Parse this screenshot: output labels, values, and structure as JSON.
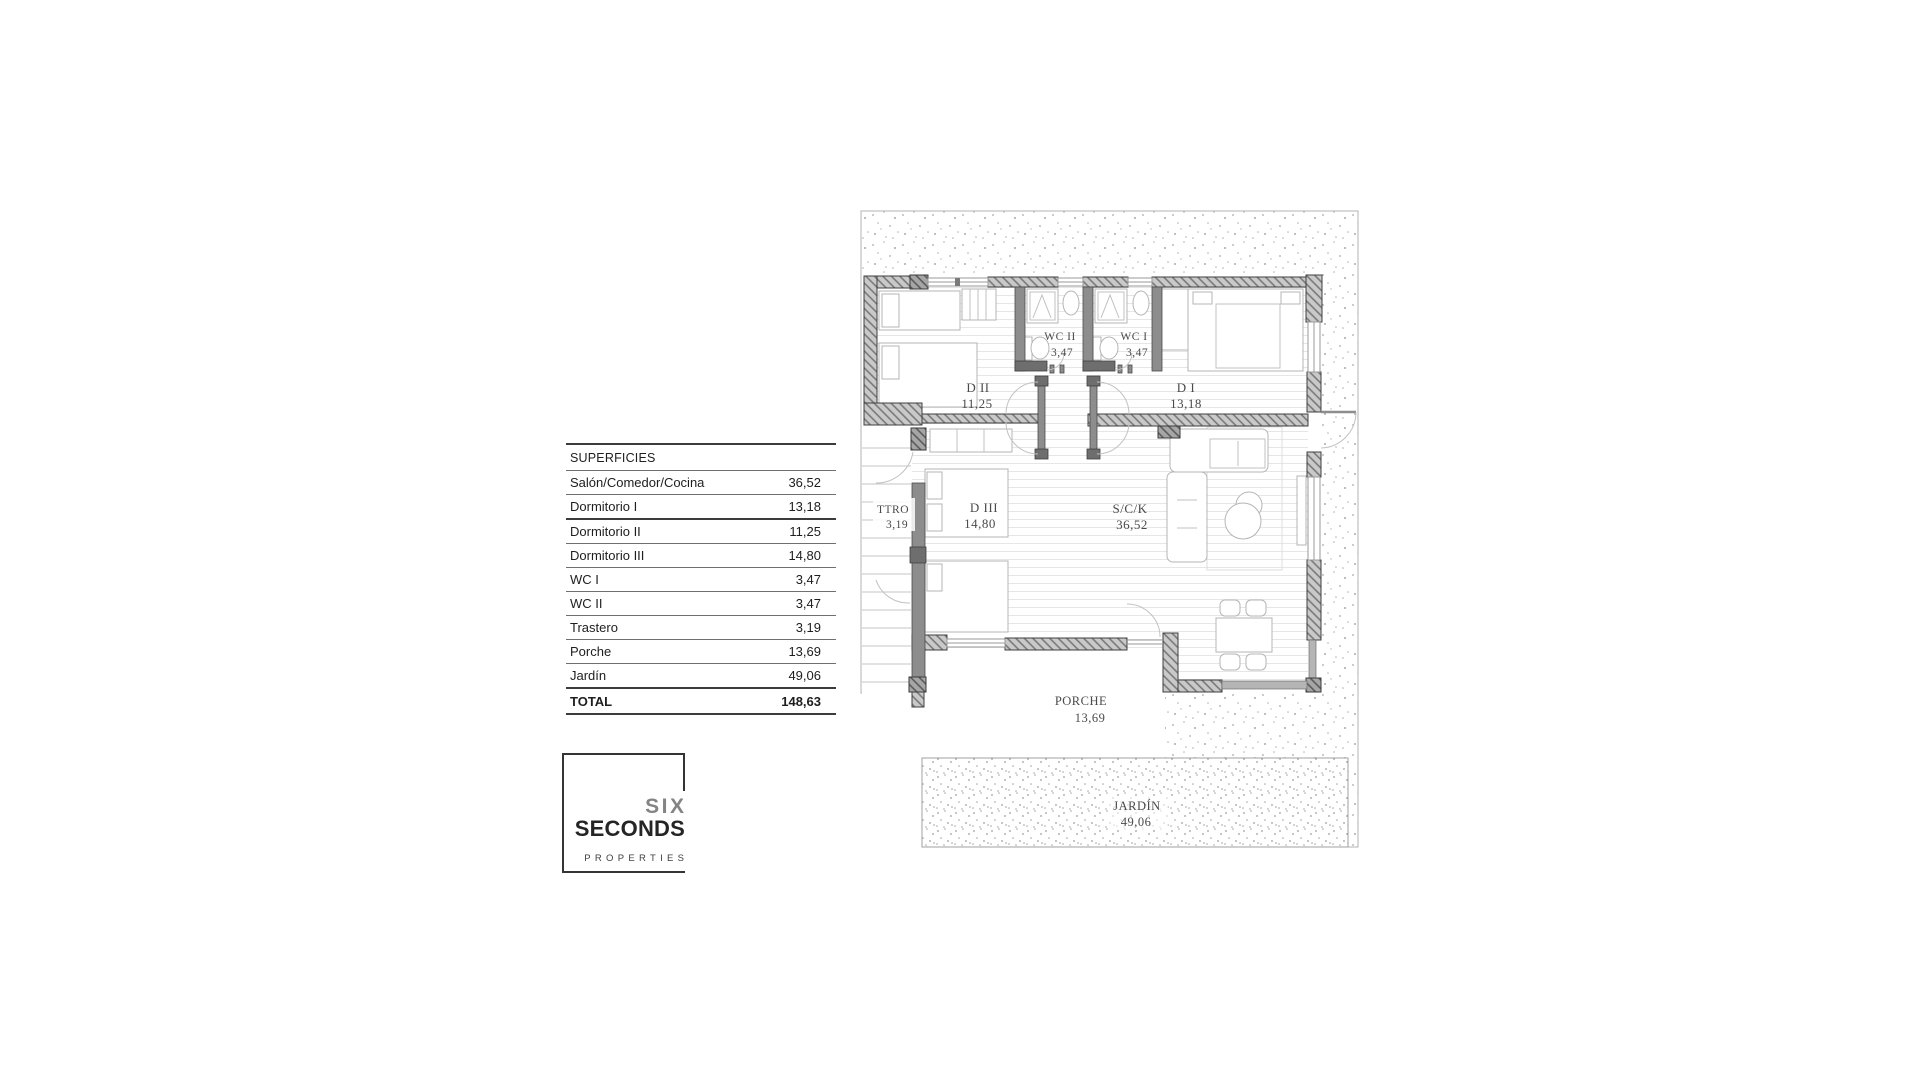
{
  "surfaces_table": {
    "header": "SUPERFICIES",
    "rows": [
      {
        "label": "Salón/Comedor/Cocina",
        "value": "36,52"
      },
      {
        "label": "Dormitorio I",
        "value": "13,18"
      },
      {
        "label": "Dormitorio II",
        "value": "11,25"
      },
      {
        "label": "Dormitorio III",
        "value": "14,80"
      },
      {
        "label": "WC I",
        "value": "3,47"
      },
      {
        "label": "WC II",
        "value": "3,47"
      },
      {
        "label": "Trastero",
        "value": "3,19"
      },
      {
        "label": "Porche",
        "value": "13,69"
      },
      {
        "label": "Jardín",
        "value": "49,06"
      }
    ],
    "total": {
      "label": "TOTAL",
      "value": "148,63"
    }
  },
  "logo": {
    "line1": "SIX",
    "line2": "SECONDS",
    "line3": "PROPERTIES"
  },
  "floorplan": {
    "rooms": [
      {
        "name": "D II",
        "area": "11,25"
      },
      {
        "name": "WC II",
        "area": "3,47"
      },
      {
        "name": "WC I",
        "area": "3,47"
      },
      {
        "name": "D I",
        "area": "13,18"
      },
      {
        "name": "TTRO",
        "area": "3,19"
      },
      {
        "name": "D III",
        "area": "14,80"
      },
      {
        "name": "S/C/K",
        "area": "36,52"
      },
      {
        "name": "PORCHE",
        "area": "13,69"
      },
      {
        "name": "JARDÍN",
        "area": "49,06"
      }
    ]
  }
}
